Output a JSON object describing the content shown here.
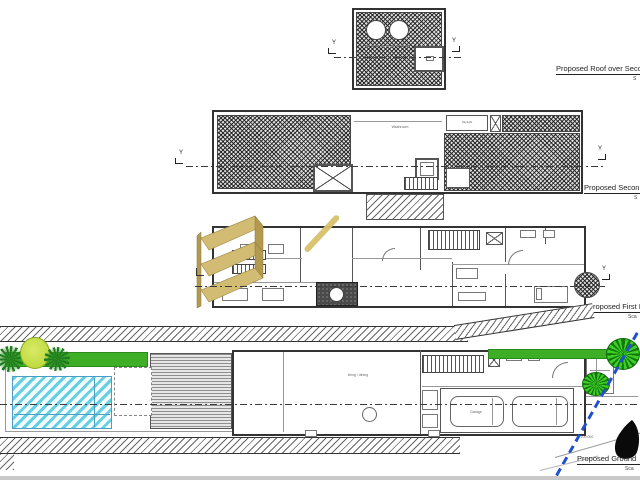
{
  "document": {
    "type": "architectural-plan-sheet",
    "background": "#ffffff"
  },
  "plan_labels": {
    "roof": {
      "title": "Proposed Roof over Seco",
      "scale": "S"
    },
    "second": {
      "title": "Proposed Secon",
      "scale": "S"
    },
    "first": {
      "title": "Proposed First F",
      "scale": "Sca"
    },
    "ground": {
      "title": "Proposed Ground",
      "scale": "Sca"
    }
  },
  "annotations": {
    "section_marker": "Y",
    "washroom": "Washroom",
    "skylight": "Skylight",
    "garage": "Garage",
    "main_room": "living / dining",
    "level_dim": "100.000"
  },
  "colors": {
    "pool": "#66cfe4",
    "lawn": "#3fae27",
    "tree": "#b5d433",
    "palm": "#1f7a1f",
    "gold": "#d2bb72",
    "gold_dark": "#b49a4f",
    "boundary_line": "#2050d0",
    "hatch": "#555555",
    "highlight": "#d6c16b"
  }
}
